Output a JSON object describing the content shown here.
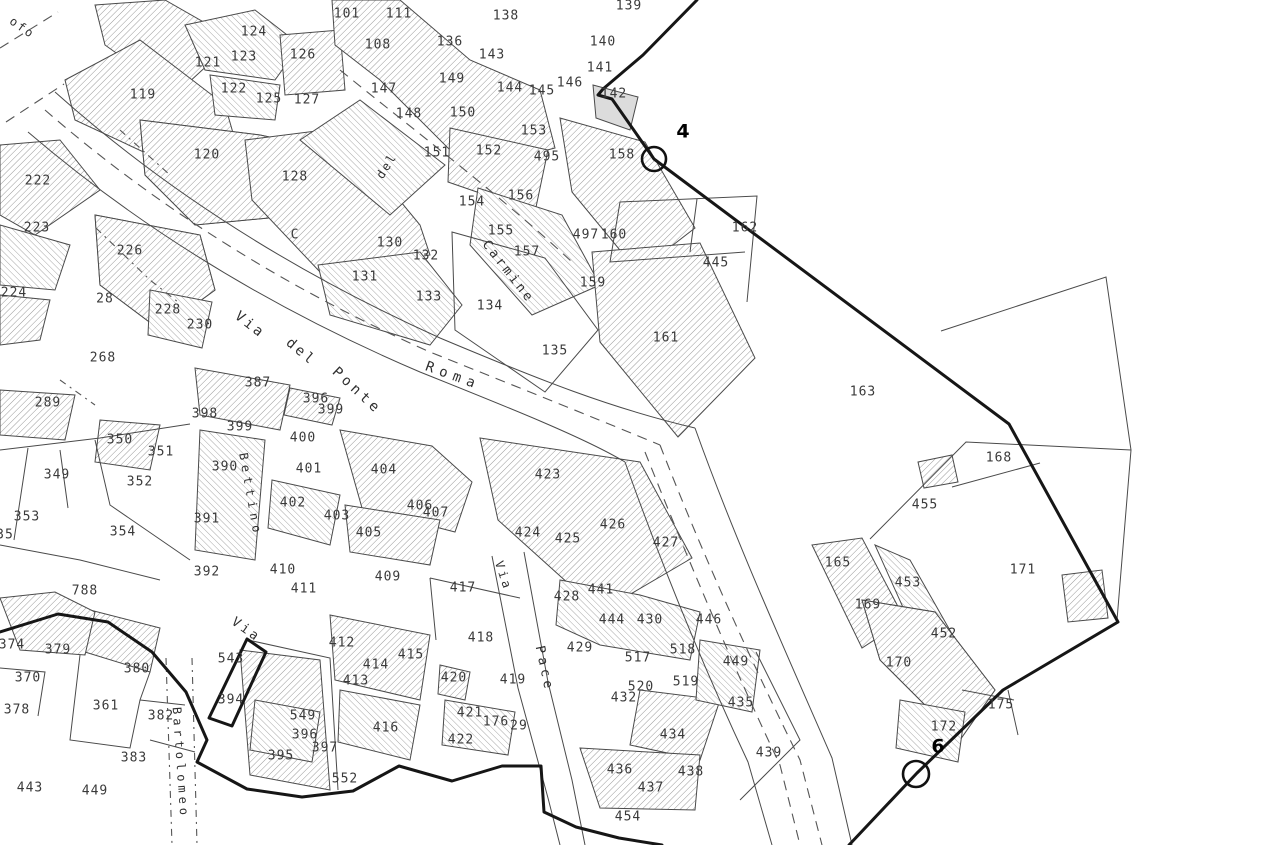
{
  "map": {
    "type": "cadastral-parcel-map",
    "colors": {
      "ink": "#3a3a3a",
      "building_outline": "#4a4a4a",
      "hatch": "#9a9a9a",
      "boundary": "#161616",
      "road_dash": "#555555",
      "background": "#ffffff"
    },
    "labels": [
      {
        "t": "101",
        "x": 347,
        "y": 14
      },
      {
        "t": "111",
        "x": 399,
        "y": 14
      },
      {
        "t": "108",
        "x": 378,
        "y": 45
      },
      {
        "t": "138",
        "x": 506,
        "y": 16
      },
      {
        "t": "139",
        "x": 629,
        "y": 6
      },
      {
        "t": "140",
        "x": 603,
        "y": 42
      },
      {
        "t": "124",
        "x": 254,
        "y": 32
      },
      {
        "t": "121",
        "x": 208,
        "y": 63
      },
      {
        "t": "123",
        "x": 244,
        "y": 57
      },
      {
        "t": "126",
        "x": 303,
        "y": 55
      },
      {
        "t": "122",
        "x": 234,
        "y": 89
      },
      {
        "t": "125",
        "x": 269,
        "y": 99
      },
      {
        "t": "127",
        "x": 307,
        "y": 100
      },
      {
        "t": "119",
        "x": 143,
        "y": 95
      },
      {
        "t": "120",
        "x": 207,
        "y": 155
      },
      {
        "t": "128",
        "x": 295,
        "y": 177
      },
      {
        "t": "136",
        "x": 450,
        "y": 42
      },
      {
        "t": "143",
        "x": 492,
        "y": 55
      },
      {
        "t": "147",
        "x": 384,
        "y": 89
      },
      {
        "t": "149",
        "x": 452,
        "y": 79
      },
      {
        "t": "148",
        "x": 409,
        "y": 114
      },
      {
        "t": "150",
        "x": 463,
        "y": 113
      },
      {
        "t": "151",
        "x": 437,
        "y": 153
      },
      {
        "t": "152",
        "x": 489,
        "y": 151
      },
      {
        "t": "153",
        "x": 534,
        "y": 131
      },
      {
        "t": "495",
        "x": 547,
        "y": 157
      },
      {
        "t": "144",
        "x": 510,
        "y": 88
      },
      {
        "t": "145",
        "x": 542,
        "y": 91
      },
      {
        "t": "146",
        "x": 570,
        "y": 83
      },
      {
        "t": "141",
        "x": 600,
        "y": 68
      },
      {
        "t": "142",
        "x": 614,
        "y": 94
      },
      {
        "t": "158",
        "x": 622,
        "y": 155
      },
      {
        "t": "154",
        "x": 472,
        "y": 202
      },
      {
        "t": "156",
        "x": 521,
        "y": 196
      },
      {
        "t": "155",
        "x": 501,
        "y": 231
      },
      {
        "t": "157",
        "x": 527,
        "y": 252
      },
      {
        "t": "497",
        "x": 586,
        "y": 235
      },
      {
        "t": "160",
        "x": 614,
        "y": 235
      },
      {
        "t": "159",
        "x": 593,
        "y": 283
      },
      {
        "t": "161",
        "x": 666,
        "y": 338
      },
      {
        "t": "162",
        "x": 745,
        "y": 228
      },
      {
        "t": "445",
        "x": 716,
        "y": 263
      },
      {
        "t": "163",
        "x": 863,
        "y": 392
      },
      {
        "t": "130",
        "x": 390,
        "y": 243
      },
      {
        "t": "132",
        "x": 426,
        "y": 256
      },
      {
        "t": "131",
        "x": 365,
        "y": 277
      },
      {
        "t": "133",
        "x": 429,
        "y": 297
      },
      {
        "t": "134",
        "x": 490,
        "y": 306
      },
      {
        "t": "135",
        "x": 555,
        "y": 351
      },
      {
        "t": "C",
        "x": 295,
        "y": 235,
        "s": 11
      },
      {
        "t": "222",
        "x": 38,
        "y": 181
      },
      {
        "t": "223",
        "x": 37,
        "y": 228
      },
      {
        "t": "224",
        "x": 14,
        "y": 293
      },
      {
        "t": "226",
        "x": 130,
        "y": 251
      },
      {
        "t": "28",
        "x": 105,
        "y": 299,
        "s": 11
      },
      {
        "t": "228",
        "x": 168,
        "y": 310
      },
      {
        "t": "230",
        "x": 200,
        "y": 325
      },
      {
        "t": "268",
        "x": 103,
        "y": 358
      },
      {
        "t": "289",
        "x": 48,
        "y": 403
      },
      {
        "t": "387",
        "x": 258,
        "y": 383
      },
      {
        "t": "398",
        "x": 205,
        "y": 414
      },
      {
        "t": "399",
        "x": 240,
        "y": 427
      },
      {
        "t": "396",
        "x": 316,
        "y": 399
      },
      {
        "t": "399",
        "x": 331,
        "y": 410
      },
      {
        "t": "350",
        "x": 120,
        "y": 440
      },
      {
        "t": "351",
        "x": 161,
        "y": 452
      },
      {
        "t": "352",
        "x": 140,
        "y": 482
      },
      {
        "t": "349",
        "x": 57,
        "y": 475
      },
      {
        "t": "353",
        "x": 27,
        "y": 517
      },
      {
        "t": "354",
        "x": 123,
        "y": 532
      },
      {
        "t": "35",
        "x": 5,
        "y": 535,
        "s": 11
      },
      {
        "t": "390",
        "x": 225,
        "y": 467
      },
      {
        "t": "391",
        "x": 207,
        "y": 519
      },
      {
        "t": "392",
        "x": 207,
        "y": 572
      },
      {
        "t": "788",
        "x": 85,
        "y": 591
      },
      {
        "t": "400",
        "x": 303,
        "y": 438
      },
      {
        "t": "401",
        "x": 309,
        "y": 469
      },
      {
        "t": "402",
        "x": 293,
        "y": 503
      },
      {
        "t": "403",
        "x": 337,
        "y": 516
      },
      {
        "t": "404",
        "x": 384,
        "y": 470
      },
      {
        "t": "405",
        "x": 369,
        "y": 533
      },
      {
        "t": "406",
        "x": 420,
        "y": 506
      },
      {
        "t": "407",
        "x": 436,
        "y": 513
      },
      {
        "t": "409",
        "x": 388,
        "y": 577
      },
      {
        "t": "410",
        "x": 283,
        "y": 570
      },
      {
        "t": "411",
        "x": 304,
        "y": 589
      },
      {
        "t": "417",
        "x": 463,
        "y": 588
      },
      {
        "t": "423",
        "x": 548,
        "y": 475
      },
      {
        "t": "424",
        "x": 528,
        "y": 533
      },
      {
        "t": "425",
        "x": 568,
        "y": 539
      },
      {
        "t": "426",
        "x": 613,
        "y": 525
      },
      {
        "t": "427",
        "x": 666,
        "y": 543
      },
      {
        "t": "441",
        "x": 601,
        "y": 590
      },
      {
        "t": "428",
        "x": 567,
        "y": 597
      },
      {
        "t": "444",
        "x": 612,
        "y": 620
      },
      {
        "t": "430",
        "x": 650,
        "y": 620
      },
      {
        "t": "446",
        "x": 709,
        "y": 620
      },
      {
        "t": "429",
        "x": 580,
        "y": 648
      },
      {
        "t": "517",
        "x": 638,
        "y": 658
      },
      {
        "t": "518",
        "x": 683,
        "y": 650
      },
      {
        "t": "449",
        "x": 736,
        "y": 662
      },
      {
        "t": "520",
        "x": 641,
        "y": 687
      },
      {
        "t": "519",
        "x": 686,
        "y": 682
      },
      {
        "t": "432",
        "x": 624,
        "y": 698
      },
      {
        "t": "435",
        "x": 741,
        "y": 703
      },
      {
        "t": "434",
        "x": 673,
        "y": 735
      },
      {
        "t": "439",
        "x": 769,
        "y": 753
      },
      {
        "t": "436",
        "x": 620,
        "y": 770
      },
      {
        "t": "438",
        "x": 691,
        "y": 772
      },
      {
        "t": "437",
        "x": 651,
        "y": 788
      },
      {
        "t": "454",
        "x": 628,
        "y": 817
      },
      {
        "t": "412",
        "x": 342,
        "y": 643
      },
      {
        "t": "414",
        "x": 376,
        "y": 665
      },
      {
        "t": "415",
        "x": 411,
        "y": 655
      },
      {
        "t": "413",
        "x": 356,
        "y": 681
      },
      {
        "t": "418",
        "x": 481,
        "y": 638
      },
      {
        "t": "420",
        "x": 454,
        "y": 678
      },
      {
        "t": "419",
        "x": 513,
        "y": 680
      },
      {
        "t": "421",
        "x": 470,
        "y": 713
      },
      {
        "t": "416",
        "x": 386,
        "y": 728
      },
      {
        "t": "422",
        "x": 461,
        "y": 740
      },
      {
        "t": "176",
        "x": 496,
        "y": 722,
        "s": 10
      },
      {
        "t": "29",
        "x": 519,
        "y": 726,
        "s": 10
      },
      {
        "t": "397",
        "x": 325,
        "y": 748
      },
      {
        "t": "552",
        "x": 345,
        "y": 779
      },
      {
        "t": "374",
        "x": 12,
        "y": 645
      },
      {
        "t": "379",
        "x": 58,
        "y": 650
      },
      {
        "t": "370",
        "x": 28,
        "y": 678
      },
      {
        "t": "378",
        "x": 17,
        "y": 710
      },
      {
        "t": "380",
        "x": 137,
        "y": 669
      },
      {
        "t": "361",
        "x": 106,
        "y": 706
      },
      {
        "t": "382",
        "x": 161,
        "y": 716
      },
      {
        "t": "383",
        "x": 134,
        "y": 758
      },
      {
        "t": "443",
        "x": 30,
        "y": 788
      },
      {
        "t": "449",
        "x": 95,
        "y": 791
      },
      {
        "t": "394",
        "x": 231,
        "y": 700
      },
      {
        "t": "543",
        "x": 231,
        "y": 659
      },
      {
        "t": "549",
        "x": 303,
        "y": 716
      },
      {
        "t": "395",
        "x": 281,
        "y": 756
      },
      {
        "t": "396",
        "x": 305,
        "y": 735
      },
      {
        "t": "165",
        "x": 838,
        "y": 563
      },
      {
        "t": "169",
        "x": 868,
        "y": 605
      },
      {
        "t": "453",
        "x": 908,
        "y": 583
      },
      {
        "t": "452",
        "x": 944,
        "y": 634
      },
      {
        "t": "170",
        "x": 899,
        "y": 663
      },
      {
        "t": "168",
        "x": 999,
        "y": 458
      },
      {
        "t": "455",
        "x": 925,
        "y": 505
      },
      {
        "t": "171",
        "x": 1023,
        "y": 570
      },
      {
        "t": "175",
        "x": 1001,
        "y": 705
      },
      {
        "t": "172",
        "x": 944,
        "y": 727
      }
    ],
    "streets": [
      {
        "t": "ofo",
        "x": 22,
        "y": 28,
        "r": 35,
        "s": 12,
        "ls": 2
      },
      {
        "t": "Via",
        "x": 250,
        "y": 325,
        "r": 38,
        "s": 14,
        "ls": 3
      },
      {
        "t": "del",
        "x": 301,
        "y": 352,
        "r": 40,
        "s": 14,
        "ls": 3
      },
      {
        "t": "Ponte",
        "x": 357,
        "y": 391,
        "r": 43,
        "s": 14,
        "ls": 4
      },
      {
        "t": "Roma",
        "x": 453,
        "y": 376,
        "r": 20,
        "s": 14,
        "ls": 6
      },
      {
        "t": "del",
        "x": 387,
        "y": 166,
        "r": -58,
        "s": 12,
        "ls": 2
      },
      {
        "t": "Carmine",
        "x": 508,
        "y": 272,
        "r": 52,
        "s": 13,
        "ls": 3
      },
      {
        "t": "Bettino",
        "x": 250,
        "y": 495,
        "r": 80,
        "s": 12,
        "ls": 5
      },
      {
        "t": "Via",
        "x": 246,
        "y": 630,
        "r": 35,
        "s": 13,
        "ls": 3
      },
      {
        "t": "Bartolomeo",
        "x": 180,
        "y": 763,
        "r": 86,
        "s": 12,
        "ls": 4
      },
      {
        "t": "Via",
        "x": 503,
        "y": 576,
        "r": 72,
        "s": 12,
        "ls": 3
      },
      {
        "t": "Pace",
        "x": 544,
        "y": 669,
        "r": 78,
        "s": 13,
        "ls": 4
      }
    ],
    "markers": [
      {
        "t": "4",
        "x": 683,
        "y": 132,
        "cx": 654,
        "cy": 159,
        "cr": 12
      },
      {
        "t": "6",
        "x": 938,
        "y": 747,
        "cx": 916,
        "cy": 774,
        "cr": 13
      }
    ]
  }
}
